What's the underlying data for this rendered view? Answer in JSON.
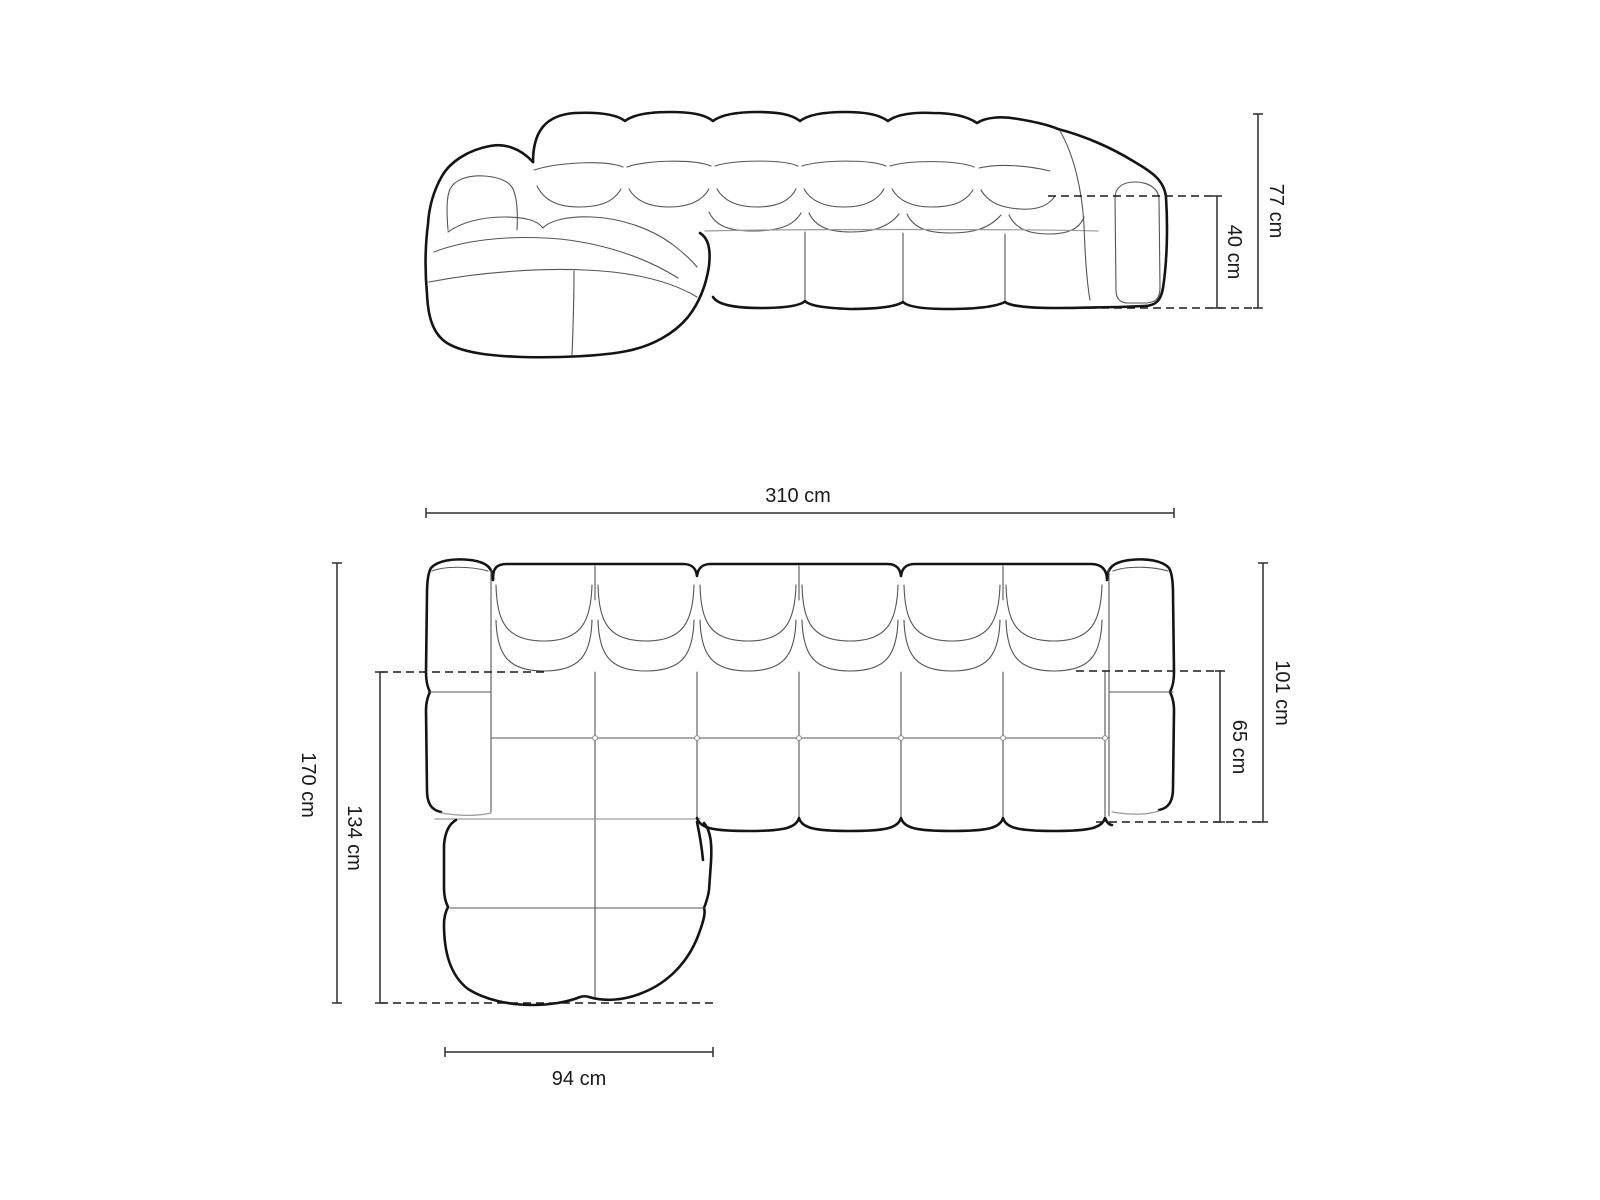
{
  "canvas": {
    "width": 1600,
    "height": 1200,
    "background": "#ffffff"
  },
  "drawing": {
    "subject": "corner-sofa-dimension-diagram",
    "outline_color": "#141414",
    "seam_color": "#555555",
    "dim_line_color": "#2e2e2e",
    "text_color": "#1a1a1a"
  },
  "front_view": {
    "dims": {
      "total_height": "77 cm",
      "arm_height": "40 cm"
    }
  },
  "top_view": {
    "dims": {
      "total_width": "310 cm",
      "total_depth": "170 cm",
      "chaise_depth": "134 cm",
      "body_depth": "101 cm",
      "seat_depth": "65 cm",
      "chaise_width": "94 cm"
    }
  }
}
